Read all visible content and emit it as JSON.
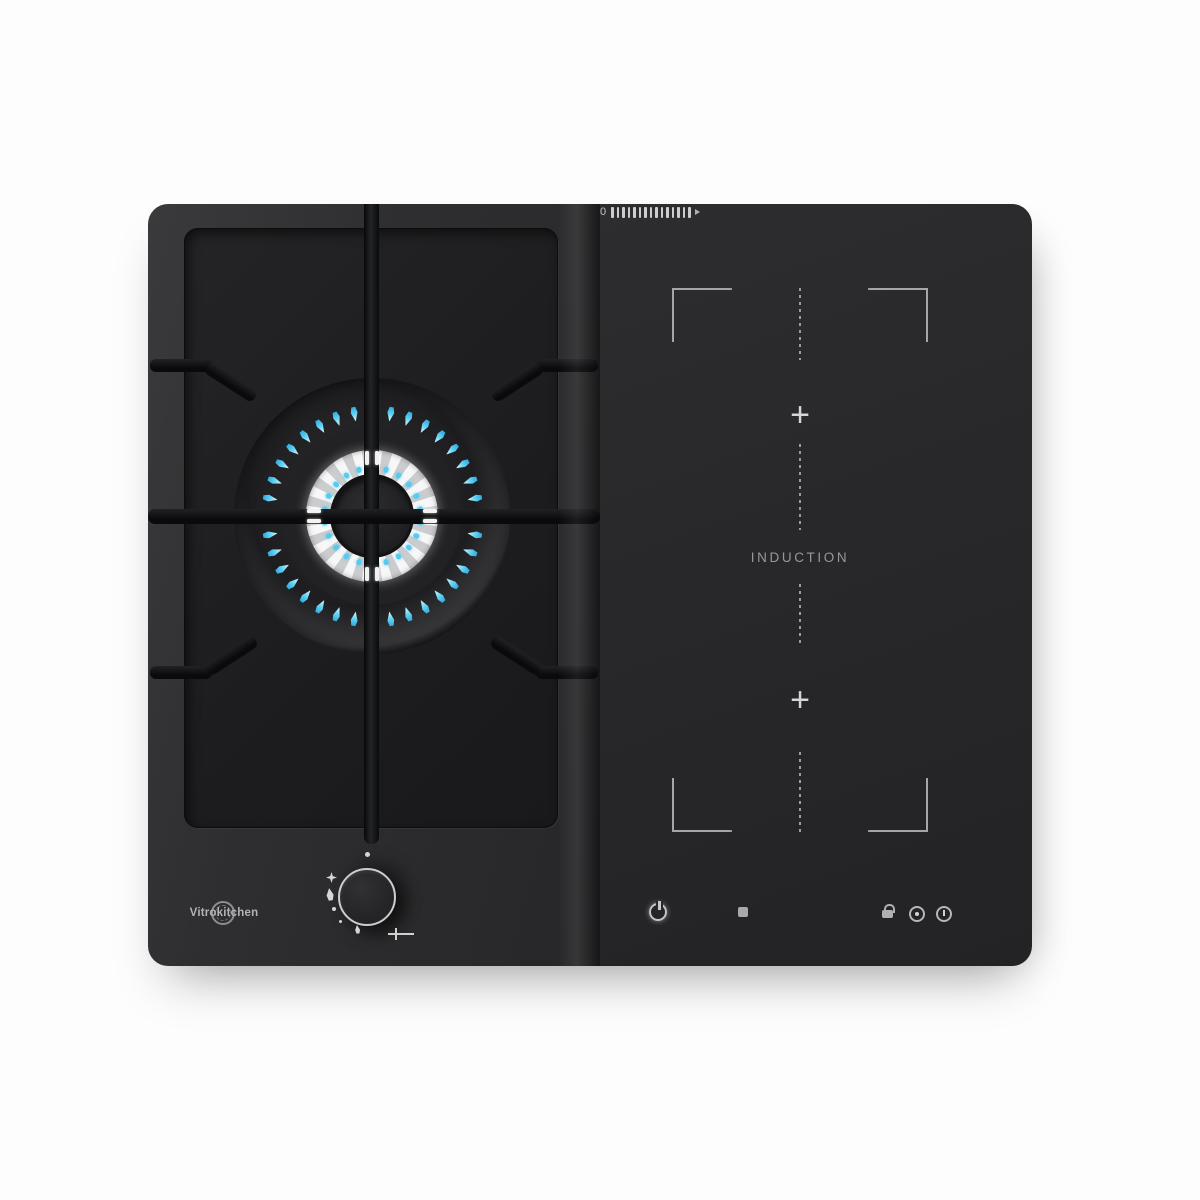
{
  "product": {
    "brand": "Vitrokitchen",
    "category": "gas-and-induction-hob"
  },
  "colors": {
    "page_background": "#fdfdfd",
    "hob_surface": "#2c2c2e",
    "gas_glass_panel": "#1d1d1f",
    "induction_surface": "#28282a",
    "pan_support_black": "#0c0c0e",
    "flame_blue": "#55cbf0",
    "flame_tip_white": "#dffaff",
    "burner_ring_white": "#ececec",
    "marking_gray": "#b4b4b6"
  },
  "gas_zone": {
    "burner": {
      "outer_flame_count": 36,
      "inner_dot_count": 22
    },
    "knob_symbols": [
      "off-dot",
      "ignition-spark",
      "flame-large",
      "dot",
      "dot",
      "flame-small",
      "crosshair-marker"
    ]
  },
  "induction_zone": {
    "label": "INDUCTION",
    "zones": [
      {
        "name": "flex-zone-top",
        "marker": "+"
      },
      {
        "name": "flex-zone-bottom",
        "marker": "+"
      }
    ]
  },
  "controls": {
    "power_min_label": "0",
    "slider_segment_count": 15,
    "icons": [
      "power",
      "stop",
      "power-slider",
      "lock",
      "timer",
      "clock"
    ]
  }
}
